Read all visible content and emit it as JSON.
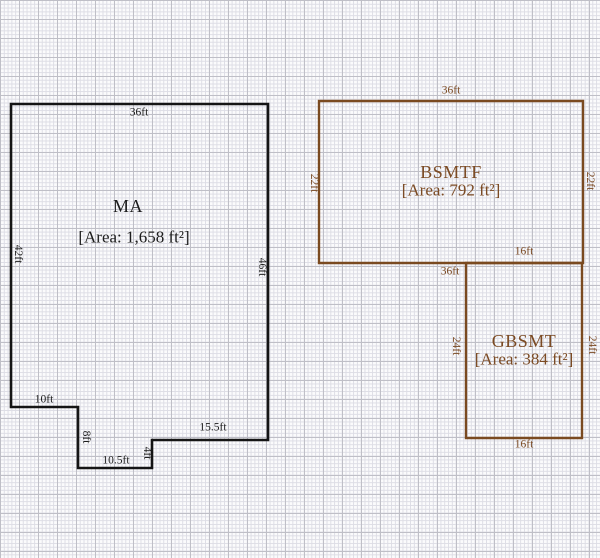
{
  "canvas": {
    "width": 600,
    "height": 558
  },
  "palette": {
    "paper": "#fbfbfc",
    "grid_minor": "#dddde5",
    "grid_major": "#bfbfc7",
    "ma_outline": "#151515",
    "basement_outline": "#7a4a20",
    "basement_text": "#7b4a23"
  },
  "shapes": {
    "ma": {
      "name": "MA",
      "area": "[Area: 1,658 ft²]",
      "points": "11,104 268,104 268,440 152,440 152,468 78,468 78,407 11,407",
      "dims": {
        "top": "36ft",
        "left": "42ft",
        "right": "46ft",
        "step": "10ft",
        "step_down": "8ft",
        "bottom": "10.5ft",
        "notch": "4ft",
        "bottom_right": "15.5ft"
      }
    },
    "bsmtf": {
      "name": "BSMTF",
      "area": "[Area: 792 ft²]",
      "points": "319,101 583,101 583,263 319,263",
      "dims": {
        "top": "36ft",
        "left": "22ft",
        "right": "22ft",
        "bottom": "36ft"
      }
    },
    "gbsmt": {
      "name": "GBSMT",
      "area": "[Area: 384 ft²]",
      "points": "466,263 582,263 582,438 466,438",
      "dims": {
        "top": "16ft",
        "left": "24ft",
        "right": "24ft",
        "bottom": "16ft"
      }
    }
  }
}
